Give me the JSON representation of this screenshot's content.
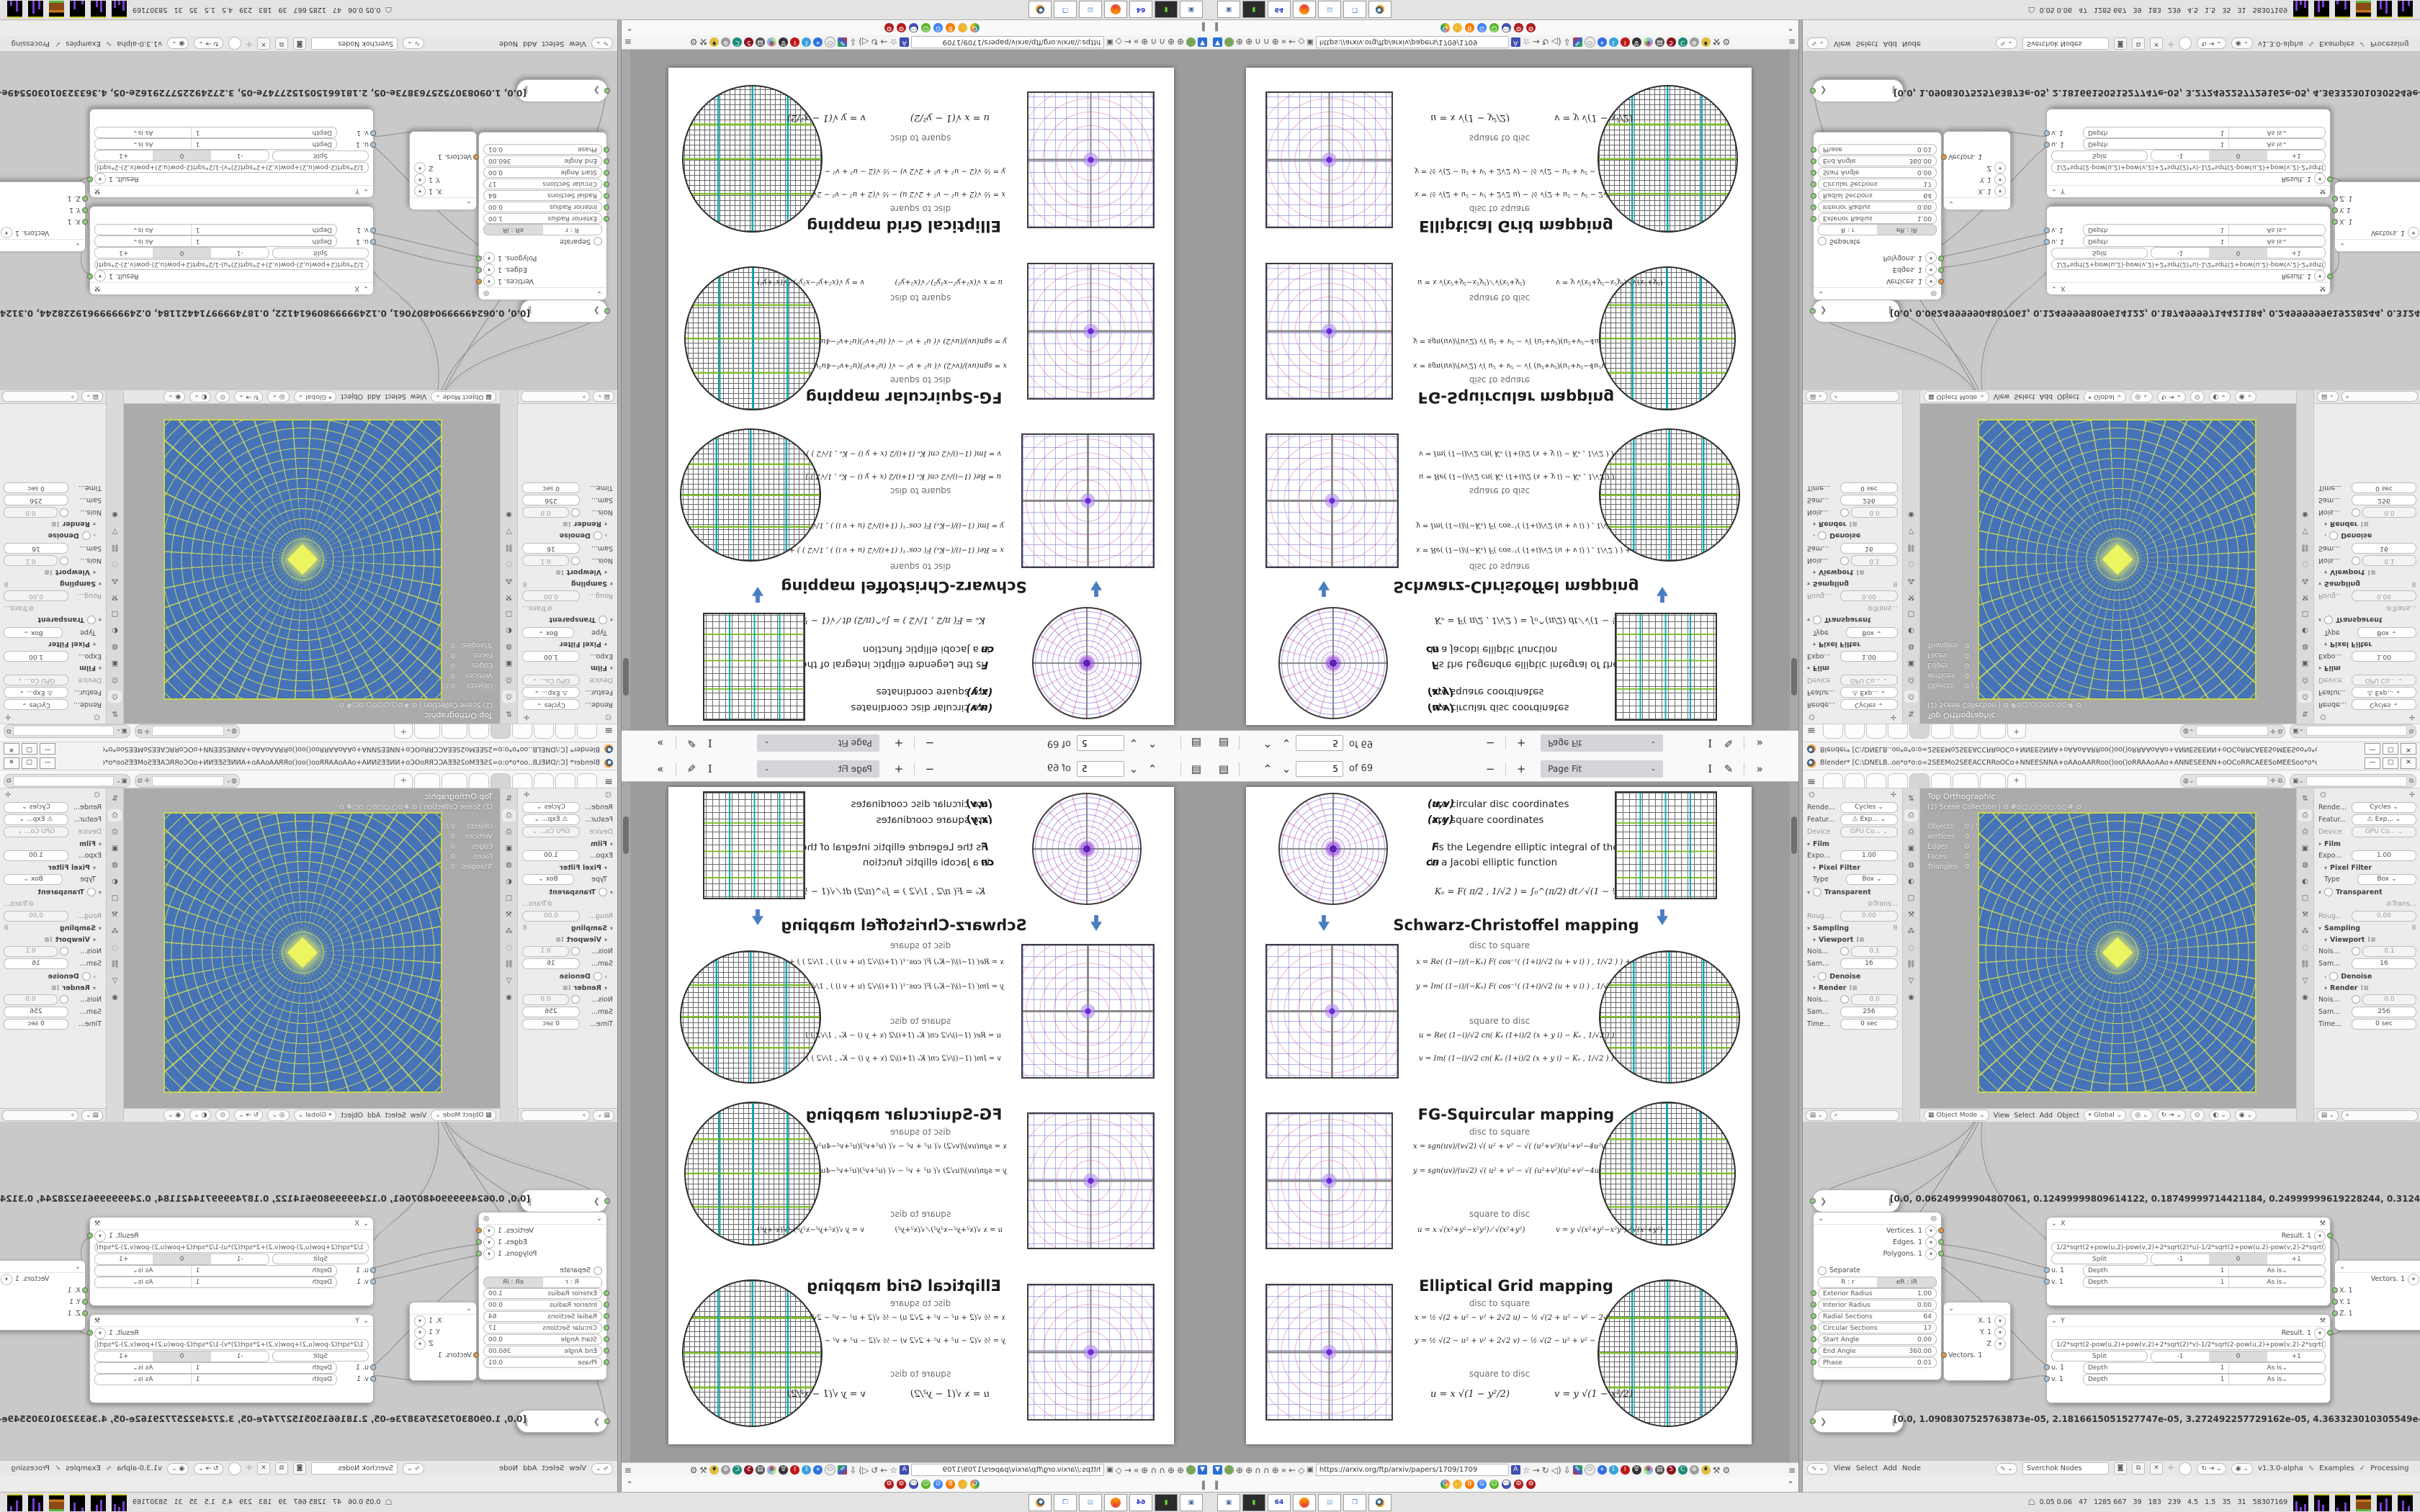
{
  "pdf": {
    "toolbar": {
      "page": "5",
      "of": "of 69",
      "zoom": "Page Fit"
    },
    "url": "https://arxiv.org/ftp/arxiv/papers/1709/1709",
    "page": {
      "intro": {
        "uv": "(u,v)",
        "uv_desc": "are circular disc coordinates",
        "xy": "(x,y)",
        "xy_desc": "are square coordinates",
        "f": "F",
        "f_desc": "is the Legendre elliptic integral of the 1st kind",
        "cn": "cn",
        "cn_desc": "is a Jacobi elliptic function",
        "ke": "Kₑ = F( π/2 , 1/√2 ) = ∫₀^(π/2) dt ⁄ √(1 − ½ sin²t)  ≈ 1.854"
      },
      "sc": {
        "title": "Schwarz-Christoffel mapping",
        "d2s": "disc to square",
        "s2d": "square to disc",
        "x": "x = Re( (1−i)/(−Kₑ) F( cos⁻¹( (1+i)/√2 (u + v i) ) , 1/√2 ) ) + 1",
        "y": "y = Im( (1−i)/(−Kₑ) F( cos⁻¹( (1+i)/√2 (u + v i) ) , 1/√2 ) ) − 1",
        "u": "u = Re( (1−i)/√2  cn( Kₑ (1+i)/2 (x + y i) − Kₑ , 1/√2 ) )",
        "v": "v = Im( (1−i)/√2  cn( Kₑ (1+i)/2 (x + y i) − Kₑ , 1/√2 ) )"
      },
      "fg": {
        "title": "FG-Squircular mapping",
        "d2s": "disc to square",
        "s2d": "square to disc",
        "x": "x = sgn(uv)/(v√2) √( u² + v² − √( (u²+v²)(u²+v²−4u²v²) ) )",
        "y": "y = sgn(uv)/(u√2) √( u² + v² − √( (u²+v²)(u²+v²−4u²v²) ) )",
        "u": "u = x √(x²+y²−x²y²) ⁄ √(x²+y²)",
        "v": "v = y √(x²+y²−x²y²) ⁄ √(x²+y²)"
      },
      "eg": {
        "title": "Elliptical Grid mapping",
        "d2s": "disc to square",
        "s2d": "square to disc",
        "x": "x = ½ √(2 + u² − v² + 2√2 u)  −  ½ √(2 + u² − v² − 2√2 u)",
        "y": "y = ½ √(2 − u² + v² + 2√2 v)  −  ½ √(2 − u² + v² − 2√2 v)",
        "u": "u = x √(1 − y²/2)",
        "v": "v = y √(1 − x²/2)"
      }
    }
  },
  "blender": {
    "title": "Blender* [C:\\DNELB..oo*o*o:o=2SEEMo2SEEACCRRoOCo+NNEESNNA+oAAoAARRoo()oo()oRRAAoAAo+ANNESEENN+oOCoRRCAEESoMEESoo*o*o...",
    "props": {
      "render_l": "Rende...",
      "render_v": "Cycles",
      "feature_l": "Featur...",
      "feature_v": "Exp...",
      "device_l": "Device",
      "device_v": "GPU Co...",
      "film": "Film",
      "expo_l": "Expo...",
      "expo_v": "1.00",
      "pixel_filter": "Pixel Filter",
      "type_l": "Type",
      "type_v": "Box",
      "transparent": "Transparent",
      "trans_l": "Trans...",
      "roug_l": "Roug...",
      "roug_v": "0.00",
      "sampling": "Sampling",
      "viewport": "Viewport",
      "nois_vp_l": "Nois...",
      "nois_vp_v": "0.1",
      "sam_vp_l": "Sam...",
      "sam_vp_v": "16",
      "denoise": "Denoise",
      "render_sec": "Render",
      "nois_r_l": "Nois...",
      "nois_r_v": "0.0",
      "sam_r_l": "Sam...",
      "sam_r_v": "256",
      "time_l": "Time...",
      "time_v": "0 sec"
    },
    "viewport": {
      "view_label": "Top Orthographic",
      "scene_label": "(2) Scene Collection | ⊙ #⊙○.○○⊙○.⊙○# ⊙",
      "stats": {
        "objects_l": "Objects",
        "objects_v": "0 / 53",
        "vertices_l": "Vertices",
        "vertices_v": "0",
        "edges_l": "Edges",
        "edges_v": "0",
        "faces_l": "Faces",
        "faces_v": "0",
        "triangles_l": "Triangles",
        "triangles_v": "0"
      },
      "header": {
        "mode": "Object Mode",
        "view": "View",
        "select": "Select",
        "add": "Add",
        "object": "Object",
        "orient": "Global"
      }
    },
    "node_editor": {
      "stetho1": "[0.0, 0.06249999904807061, 0.12499999809614122, 0.18749999714421184, 0.24999999619228244, 0.31249999524035305, 0.374",
      "stetho2": "[0.0, 1.0908307525763873e-05, 2.1816615051527747e-05, 3.272492257729162e-05, 4.363323010305549e-05, 5.454153762881936",
      "circle_node": {
        "out_vertices": "Vertices. 1",
        "out_edges": "Edges. 1",
        "out_polygons": "Polygons. 1",
        "separate": "Separate",
        "seg_a": "R : r",
        "seg_b": "eR : iR",
        "rows": [
          {
            "l": "Exterior Radius",
            "v": "1.00"
          },
          {
            "l": "Interior Radius",
            "v": "0.00"
          },
          {
            "l": "Radial Sections",
            "v": "64"
          },
          {
            "l": "Circular Sections",
            "v": "17"
          },
          {
            "l": "Start Angle",
            "v": "0.00"
          },
          {
            "l": "End Angle",
            "v": "360.00"
          },
          {
            "l": "Phase",
            "v": "0.01"
          }
        ]
      },
      "vec_out_node": {
        "x": "X. 1",
        "y": "Y. 1",
        "z": "Z",
        "out": "Vectors. 1"
      },
      "x_node": {
        "title": "X",
        "result": "Result. 1",
        "formula": "1/2*sqrt(2+pow(u,2)-pow(v,2)+2*sqrt(2)*u)-1/2*sqrt(2+pow(u,2)-pow(v,2)-2*sqrt(2)*u)",
        "split": "Split",
        "m1": "-1",
        "zero": "0",
        "p1": "+1",
        "u": "u. 1",
        "v": "v. 1",
        "depth": "Depth",
        "depth_v": "1",
        "asis": "As is"
      },
      "y_node": {
        "title": "Y",
        "result": "Result. 1",
        "formula": "1/2*sqrt(2-pow(u,2)+pow(v,2)+2*sqrt(2)*v)-1/2*sqrt(2-pow(u,2)+pow(v,2)-2*sqrt(2)*v)",
        "split": "Split",
        "m1": "-1",
        "zero": "0",
        "p1": "+1",
        "u": "u. 1",
        "v": "v. 1",
        "depth": "Depth",
        "depth_v": "1",
        "asis": "As is"
      },
      "vec_in_node": {
        "out": "Vectors. 1",
        "x": "X. 1",
        "y": "Y. 1",
        "z": "Z. 1"
      },
      "header": {
        "view": "View",
        "select": "Select",
        "add": "Add",
        "node": "Node",
        "tree": "Sverchok Nodes",
        "version": "v1.3.0-alpha",
        "examples": "Examples",
        "processing": "Processing"
      }
    }
  },
  "taskbar": {
    "stats": "0.05 0.06   47   1285 667   39   183   239   4.5   1.5   35   31   58307169",
    "floppy_label": "64"
  },
  "colors": {
    "accent_blue": "#4673b7",
    "wire_yellow": "#d8e250",
    "blender_orange": "#f6921e",
    "arrow_blue": "#4a7ec2"
  }
}
